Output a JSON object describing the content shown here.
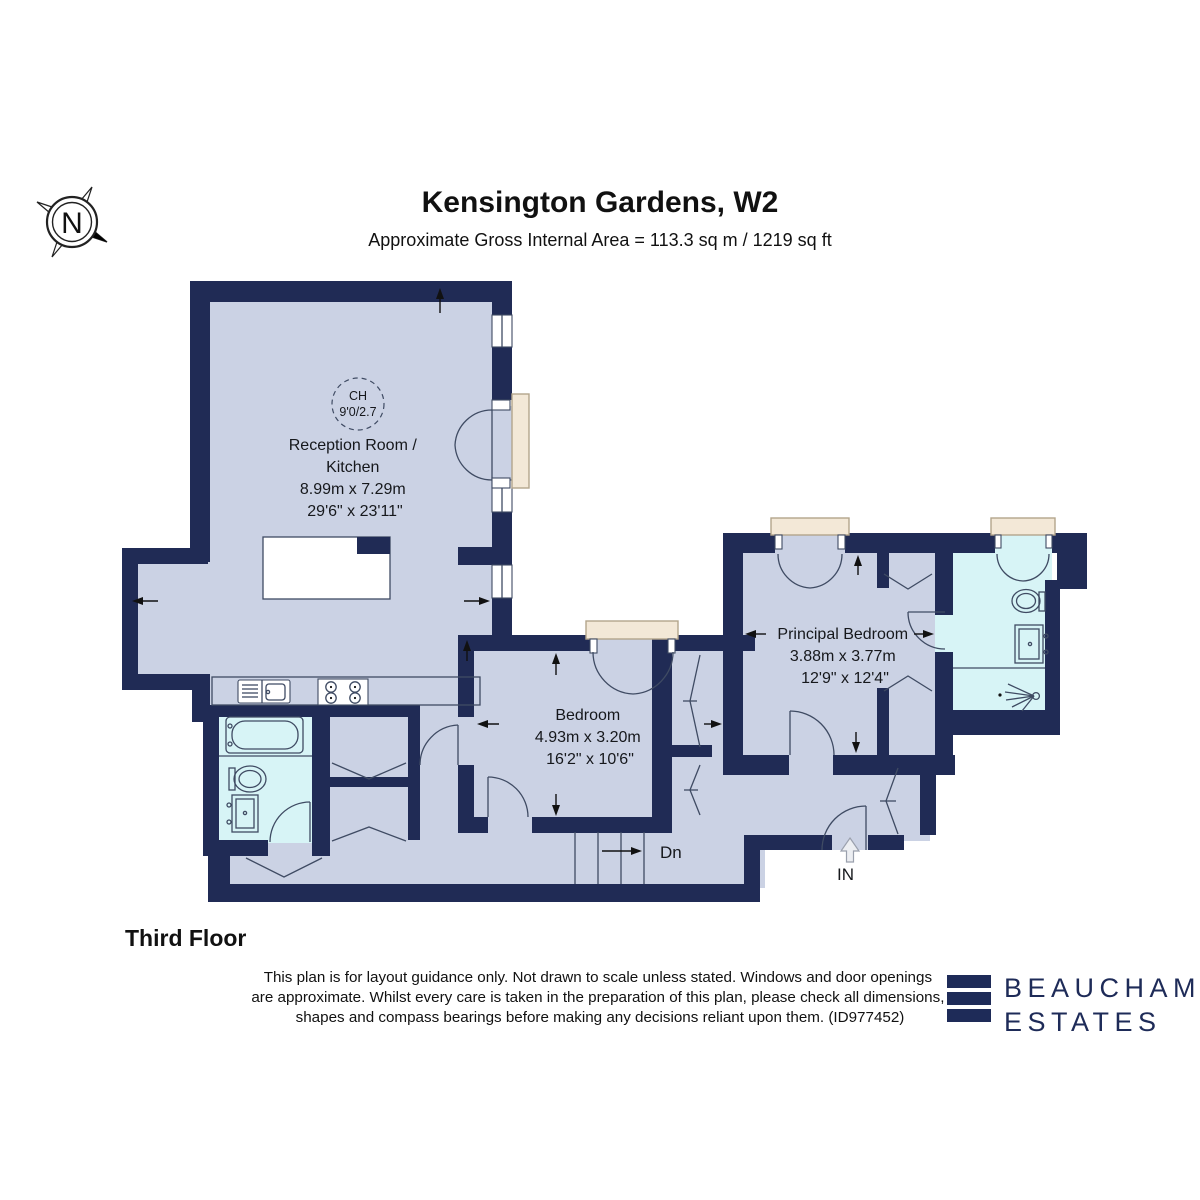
{
  "header": {
    "title": "Kensington Gardens, W2",
    "subtitle": "Approximate Gross Internal Area = 113.3 sq m / 1219 sq ft"
  },
  "floor_label": "Third Floor",
  "compass": {
    "letter": "N"
  },
  "rooms": {
    "reception": {
      "line1": "Reception Room /",
      "line2": "Kitchen",
      "metric": "8.99m x 7.29m",
      "imperial": "29'6\" x 23'11\""
    },
    "ceiling_height": {
      "label": "CH",
      "value": "9'0/2.7"
    },
    "bedroom": {
      "name": "Bedroom",
      "metric": "4.93m x 3.20m",
      "imperial": "16'2\" x 10'6\""
    },
    "principal_bedroom": {
      "name": "Principal Bedroom",
      "metric": "3.88m x 3.77m",
      "imperial": "12'9\" x 12'4\""
    }
  },
  "annotations": {
    "stairs_down": "Dn",
    "entrance": "IN"
  },
  "disclaimer": {
    "line1": "This plan is for layout guidance only. Not drawn to scale unless stated. Windows and door openings",
    "line2": "are approximate. Whilst every care is taken in the preparation of this plan, please check all dimensions,",
    "line3": "shapes and compass bearings before making any decisions reliant upon them. (ID977452)"
  },
  "logo": {
    "line1": "BEAUCHAMP",
    "line2": "ESTATES"
  },
  "colors": {
    "wall": "#202b55",
    "room_fill": "#cbd2e4",
    "bath_fill": "#d7f4f6",
    "sill_fill": "#f3e8d7",
    "logo_navy": "#1e2b58"
  }
}
